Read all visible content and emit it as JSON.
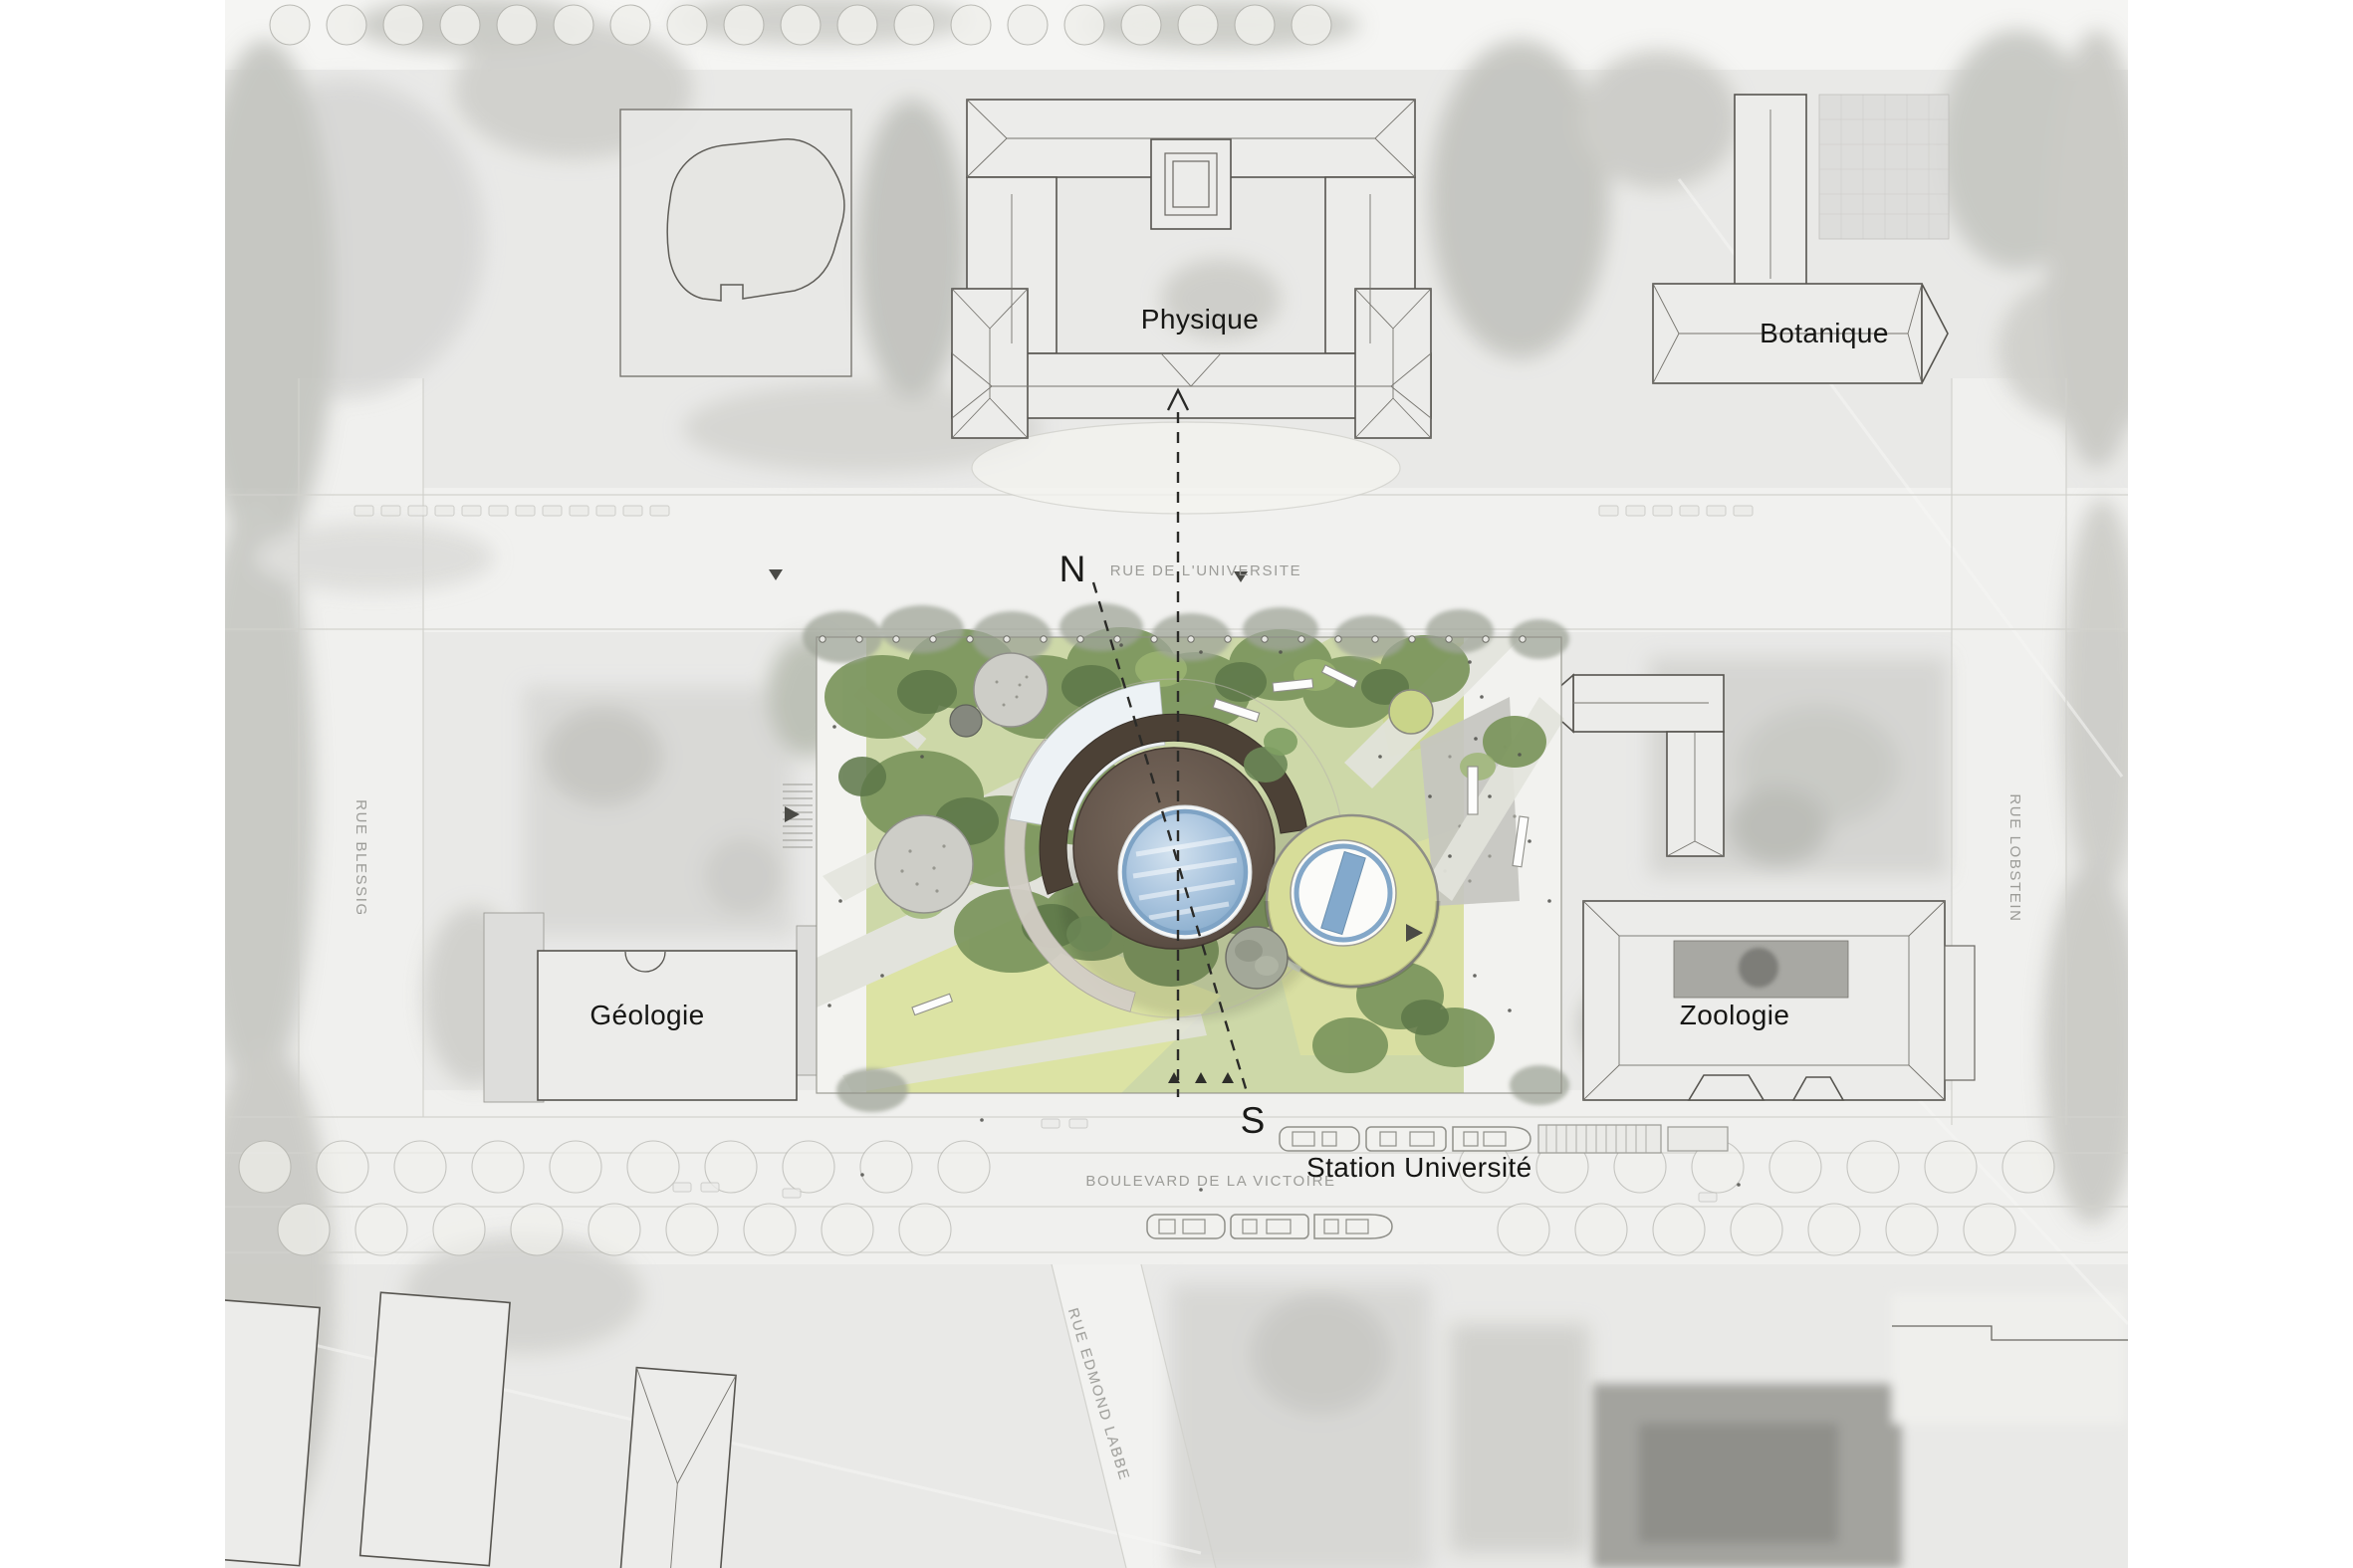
{
  "map": {
    "buildings": {
      "physique": "Physique",
      "botanique": "Botanique",
      "geologie": "Géologie",
      "zoologie": "Zoologie"
    },
    "station": {
      "label": "Station Université"
    },
    "streets": {
      "universite": "RUE DE L'UNIVERSITE",
      "victoire": "BOULEVARD DE LA VICTOIRE",
      "blessig": "RUE BLESSIG",
      "lobstein": "RUE LOBSTEIN",
      "edmond_labbe": "RUE EDMOND LABBE"
    },
    "section": {
      "north": "N",
      "south": "S"
    },
    "colors": {
      "dome_brown": "#5d5046",
      "canopy_dark": "#4c4136",
      "skylight_blue": "#a9c4de",
      "ring_blue": "#7ea3c5",
      "circle_lawn_yellow": "#d7dd99",
      "tree_green": "#6f8a58",
      "lawn_green": "#cdd8a8",
      "lawn_yellow": "#dce3a4",
      "plaza_white": "#f3f3f0",
      "aerial_gray": "#e9e9e7",
      "label_ink": "#161614",
      "street_label_gray": "#9c9c98"
    }
  }
}
